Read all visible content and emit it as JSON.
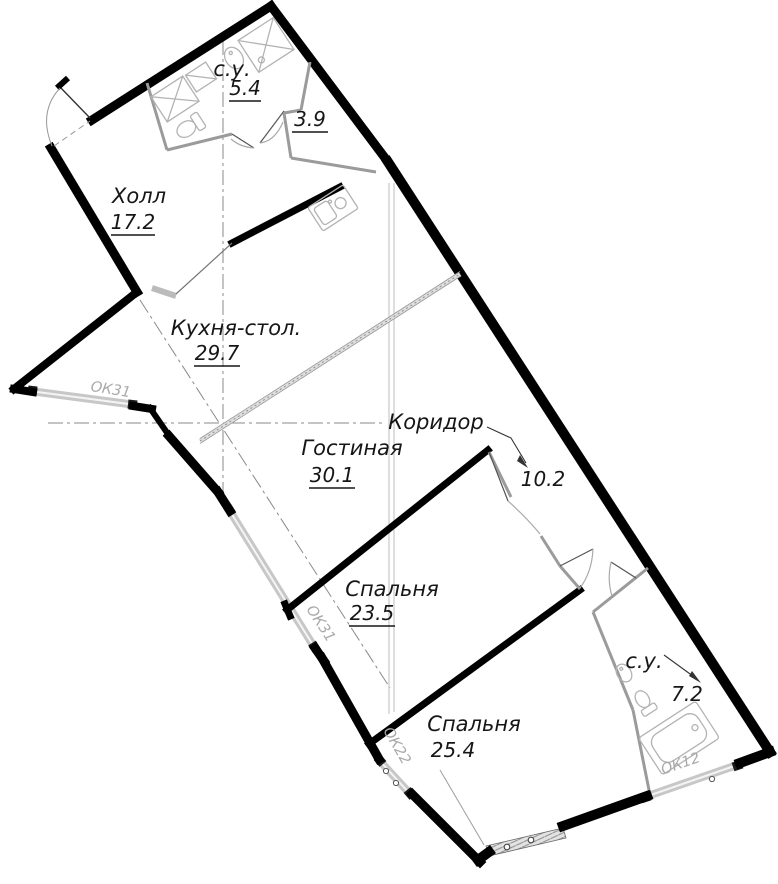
{
  "plan": {
    "title": "apartment-floor-plan",
    "rooms": {
      "bath_top": {
        "name": "с.у.",
        "area": "5.4"
      },
      "storage": {
        "name": "",
        "area": "3.9"
      },
      "hall": {
        "name": "Холл",
        "area": "17.2"
      },
      "kitchen": {
        "name": "Кухня-стол.",
        "area": "29.7"
      },
      "living": {
        "name": "Гостиная",
        "area": "30.1"
      },
      "corridor": {
        "name": "Коридор",
        "area": "10.2"
      },
      "bedroom1": {
        "name": "Спальня",
        "area": "23.5"
      },
      "bedroom2": {
        "name": "Спальня",
        "area": "25.4"
      },
      "bath_bottom": {
        "name": "с.у.",
        "area": "7.2"
      }
    },
    "windows": {
      "left_upper": "ОК31",
      "left_lower": "ОК31",
      "bottom_left": "ОК22",
      "bottom_right": "ОК12"
    },
    "colors": {
      "wall": "#000000",
      "partition": "#9b9b9b",
      "window_band": "#c7c7c7",
      "axis": "#8a8a8a",
      "fixture": "#b3b3b3",
      "text": "#161616",
      "window_text": "#a9a9a9",
      "background": "#ffffff"
    }
  }
}
